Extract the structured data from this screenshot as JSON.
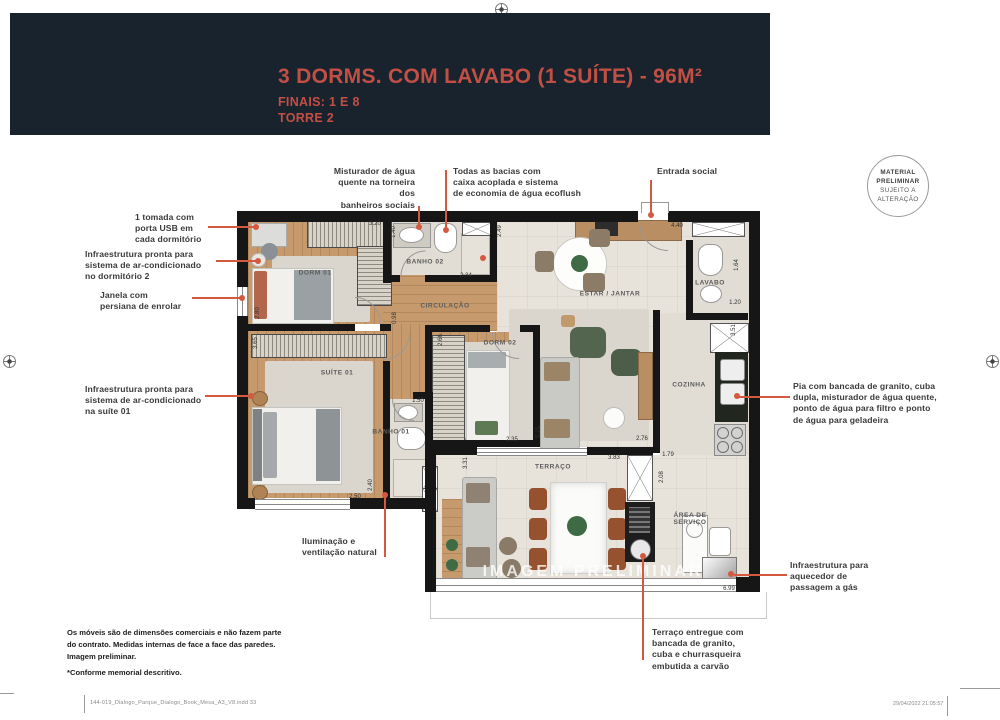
{
  "header": {
    "title": "3 DORMS. COM LAVABO (1 SUÍTE) - 96M²",
    "finals": "FINAIS: 1 E 8",
    "tower": "TORRE 2"
  },
  "stamp": {
    "line1": "MATERIAL",
    "line2": "PRELIMINAR",
    "line3": "SUJEITO A",
    "line4": "ALTERAÇÃO"
  },
  "annotations": {
    "usb": "1 tomada com\nporta USB em\ncada dormitório",
    "ac_dorm2": "Infraestrutura pronta para\nsistema de ar-condicionado\nno dormitório 2",
    "janela": "Janela com\npersiana de enrolar",
    "ac_suite": "Infraestrutura pronta para\nsistema de ar-condicionado\nna suíte 01",
    "iluminacao": "Iluminação e\nventilação natural",
    "misturador": "Misturador de água\nquente na torneira dos\nbanheiros sociais",
    "bacias": "Todas as bacias com\ncaixa acoplada e sistema\nde economia de água ecoflush",
    "entrada": "Entrada social",
    "pia": "Pia com bancada de granito, cuba\ndupla, misturador de água quente,\nponto de água para filtro e ponto\nde água para geladeira",
    "aquecedor": "Infraestrutura para\naquecedor de\npassagem a gás",
    "terraco": "Terraço entregue com\nbancada de granito,\ncuba e churrasqueira\nembutida a carvão"
  },
  "plan": {
    "watermark": "IMAGEM PRELIMINAR",
    "rooms": [
      {
        "label": "DORM 01",
        "x": 78,
        "y": 62
      },
      {
        "label": "BANHO 02",
        "x": 188,
        "y": 51
      },
      {
        "label": "CIRCULAÇÃO",
        "x": 208,
        "y": 95
      },
      {
        "label": "ESTAR / JANTAR",
        "x": 373,
        "y": 83
      },
      {
        "label": "LAVABO",
        "x": 473,
        "y": 72
      },
      {
        "label": "COZINHA",
        "x": 452,
        "y": 174
      },
      {
        "label": "DORM 02",
        "x": 263,
        "y": 132
      },
      {
        "label": "SUÍTE 01",
        "x": 100,
        "y": 162
      },
      {
        "label": "BANHO 01",
        "x": 154,
        "y": 221
      },
      {
        "label": "TERRAÇO",
        "x": 316,
        "y": 256
      },
      {
        "label": "ÁREA DE\nSERVIÇO",
        "x": 453,
        "y": 308
      }
    ],
    "dims": [
      {
        "v": "3.20",
        "x": 138,
        "y": 13,
        "rot": false
      },
      {
        "v": "1.40",
        "x": 157,
        "y": 21,
        "rot": true
      },
      {
        "v": "2.34",
        "x": 229,
        "y": 65,
        "rot": false
      },
      {
        "v": "2.49",
        "x": 263,
        "y": 20,
        "rot": true
      },
      {
        "v": "4.40",
        "x": 440,
        "y": 15,
        "rot": false
      },
      {
        "v": "1.64",
        "x": 500,
        "y": 54,
        "rot": true
      },
      {
        "v": "1.20",
        "x": 498,
        "y": 92,
        "rot": false
      },
      {
        "v": "2.80",
        "x": 21,
        "y": 102,
        "rot": true
      },
      {
        "v": "0.98",
        "x": 158,
        "y": 107,
        "rot": true
      },
      {
        "v": "3.51",
        "x": 497,
        "y": 119,
        "rot": true
      },
      {
        "v": "3.65",
        "x": 19,
        "y": 132,
        "rot": true
      },
      {
        "v": "2.66",
        "x": 204,
        "y": 129,
        "rot": true
      },
      {
        "v": "5.25",
        "x": 302,
        "y": 221,
        "rot": true
      },
      {
        "v": "2.35",
        "x": 275,
        "y": 229,
        "rot": false
      },
      {
        "v": "2.76",
        "x": 405,
        "y": 228,
        "rot": false
      },
      {
        "v": "1.50",
        "x": 181,
        "y": 190,
        "rot": false
      },
      {
        "v": "2.40",
        "x": 134,
        "y": 274,
        "rot": true
      },
      {
        "v": "2.50",
        "x": 118,
        "y": 286,
        "rot": false
      },
      {
        "v": "1.79",
        "x": 431,
        "y": 244,
        "rot": false
      },
      {
        "v": "2.08",
        "x": 425,
        "y": 266,
        "rot": true
      },
      {
        "v": "3.83",
        "x": 377,
        "y": 247,
        "rot": false
      },
      {
        "v": "3.31",
        "x": 229,
        "y": 252,
        "rot": true
      },
      {
        "v": "6.99",
        "x": 492,
        "y": 378,
        "rot": false
      }
    ]
  },
  "footer": {
    "notes": "Os móveis são de dimensões comerciais e não fazem parte\ndo contrato. Medidas internas de face a face das paredes.\nImagem preliminar.",
    "memorial": "*Conforme memorial descritivo.",
    "filename": "144-019_Dialogo_Parque_Dialogo_Book_Mesa_A3_V8.indd   33",
    "timestamp": "29/04/2022   21:05:57"
  }
}
